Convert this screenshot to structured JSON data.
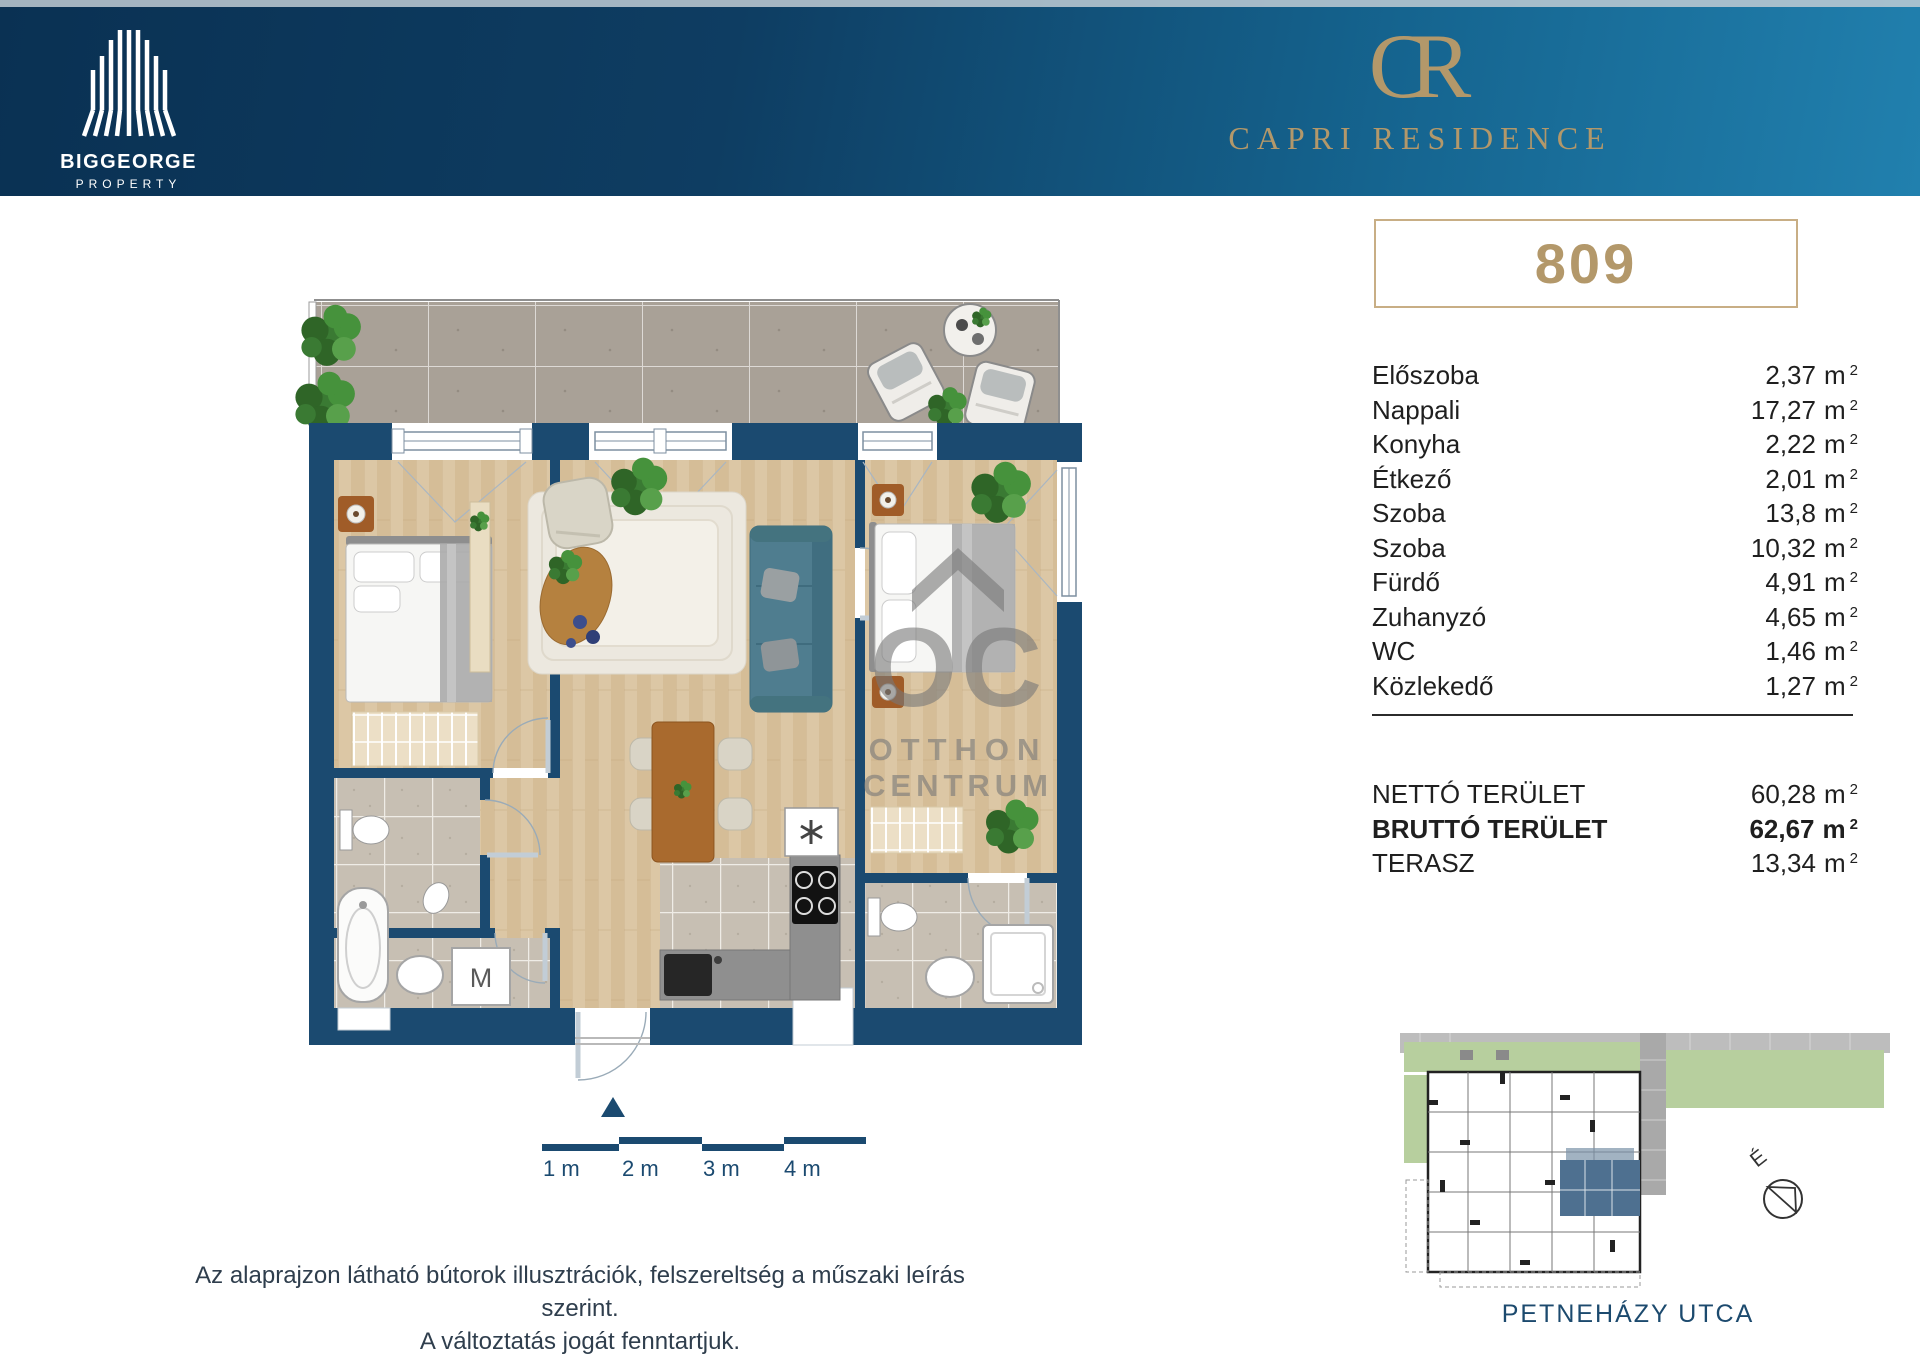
{
  "header": {
    "brand_name": "BIGGEORGE",
    "brand_sub": "PROPERTY",
    "project_monogram": "CR",
    "project_name": "CAPRI RESIDENCE"
  },
  "unit": {
    "number": "809"
  },
  "area_table": {
    "unit": "m",
    "sup": "2",
    "rooms": [
      {
        "label": "Előszoba",
        "area": "2,37"
      },
      {
        "label": "Nappali",
        "area": "17,27"
      },
      {
        "label": "Konyha",
        "area": "2,22"
      },
      {
        "label": "Étkező",
        "area": "2,01"
      },
      {
        "label": "Szoba",
        "area": "13,8"
      },
      {
        "label": "Szoba",
        "area": "10,32"
      },
      {
        "label": "Fürdő",
        "area": "4,91"
      },
      {
        "label": "Zuhanyzó",
        "area": "4,65"
      },
      {
        "label": "WC",
        "area": "1,46"
      },
      {
        "label": "Közlekedő",
        "area": "1,27"
      }
    ],
    "totals": [
      {
        "label": "NETTÓ TERÜLET",
        "area": "60,28",
        "bold": false
      },
      {
        "label": "BRUTTÓ TERÜLET",
        "area": "62,67",
        "bold": true
      },
      {
        "label": "TERASZ",
        "area": "13,34",
        "bold": false
      }
    ]
  },
  "floorplan": {
    "washer_label": "M",
    "watermark": {
      "monogram": "OC",
      "line1": "OTTHON",
      "line2": "CENTRUM"
    },
    "scalebar": {
      "l1": "1 m",
      "l2": "2 m",
      "l3": "3 m",
      "l4": "4 m"
    }
  },
  "siteplan": {
    "street": "PETNEHÁZY UTCA",
    "compass": "É"
  },
  "disclaimer": {
    "line1": "Az alaprajzon látható bútorok illusztrációk, felszereltség a műszaki leírás szerint.",
    "line2": "A változtatás jogát fenntartjuk."
  },
  "colors": {
    "navy": "#1b4a70",
    "gold": "#b3986a",
    "header_dark": "#0a3153",
    "header_light": "#2180ae",
    "highlighted_unit": "#4e7090"
  }
}
